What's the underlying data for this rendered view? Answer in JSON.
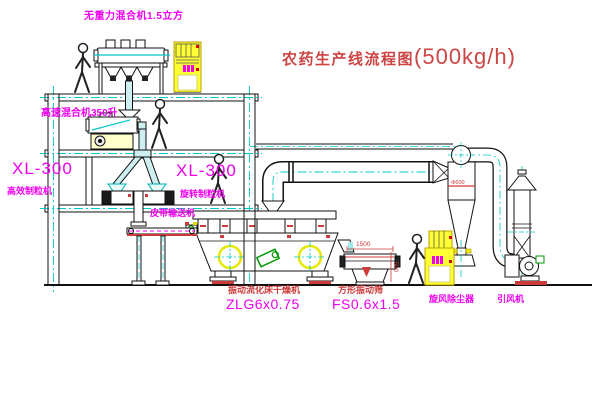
{
  "title": {
    "name_cn": "农药生产线流程图",
    "capacity": "(500kg/h)"
  },
  "labels": {
    "top_mixer": "无重力混合机1.5立方",
    "high_speed_mixer": "高速混合机350升",
    "granulator_left_model": "XL-300",
    "granulator_left_name": "高效制粒机",
    "granulator_right_model": "XL-300",
    "granulator_right_name": "旋转制粒机",
    "belt_conveyor": "皮带输送机",
    "dryer_name": "振动流化床干燥机",
    "dryer_model": "ZLG6x0.75",
    "screen_name": "方形振动筛",
    "screen_model": "FS0.6x1.5",
    "cyclone": "旋风除尘器",
    "fan": "引风机"
  },
  "dimensions": {
    "screen_length": "1500",
    "screen_height": "500",
    "cyclone_note": "Φ600"
  },
  "colors": {
    "label_magenta": "#ee00ee",
    "annotation_red": "#cc3a3a",
    "centerline_cyan": "#00c8c8",
    "machine_yellow": "#ffff33",
    "motor_green": "#009900",
    "line_black": "#000000"
  }
}
